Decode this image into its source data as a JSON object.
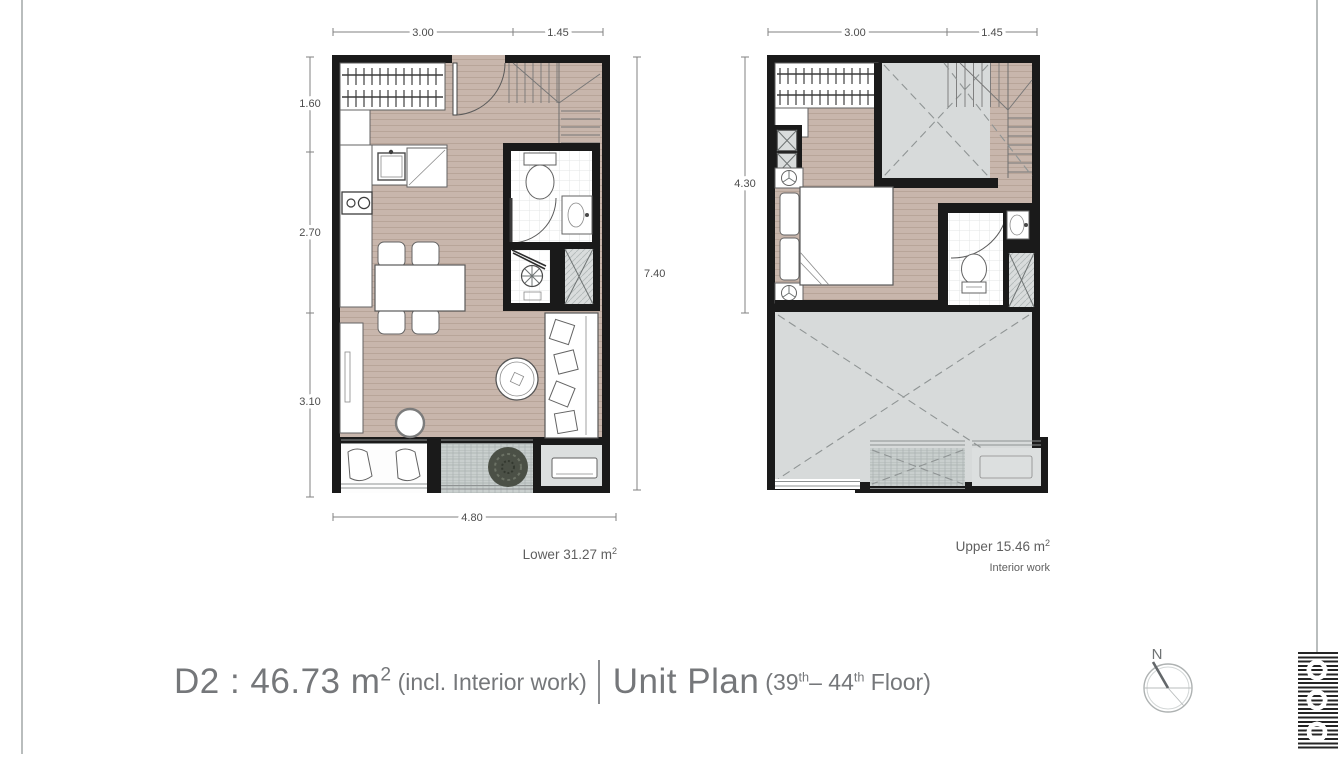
{
  "title": {
    "unit_area": "D2 : 46.73 m",
    "unit_area_sup": "2",
    "unit_area_note": "(incl. Interior work)",
    "plan_name": "Unit Plan",
    "floor_open": "(39",
    "floor_sup_a": "th",
    "floor_mid": "– 44",
    "floor_sup_b": "th",
    "floor_close": " Floor)"
  },
  "lower_plan": {
    "dims": {
      "top_left": "3.00",
      "top_right": "1.45",
      "left_top": "1.60",
      "left_mid": "2.70",
      "left_bottom": "3.10",
      "right": "7.40",
      "bottom": "4.80"
    },
    "area": "Lower 31.27 m",
    "area_sup": "2"
  },
  "upper_plan": {
    "dims": {
      "top_left": "3.00",
      "top_right": "1.45",
      "left": "4.30"
    },
    "area": "Upper 15.46 m",
    "area_sup": "2",
    "note": "Interior work"
  },
  "compass": {
    "north_label": "N"
  },
  "icons": {
    "compass": "north-compass-icon",
    "logo": "striped-brand-logo"
  },
  "colors": {
    "floor": "#c8b6ac",
    "wall": "#1a1a1a",
    "void_gray": "#d7dada",
    "deck_gray": "#c9cfce",
    "title_text": "#75777a",
    "dim_text": "#4c4c4c"
  }
}
